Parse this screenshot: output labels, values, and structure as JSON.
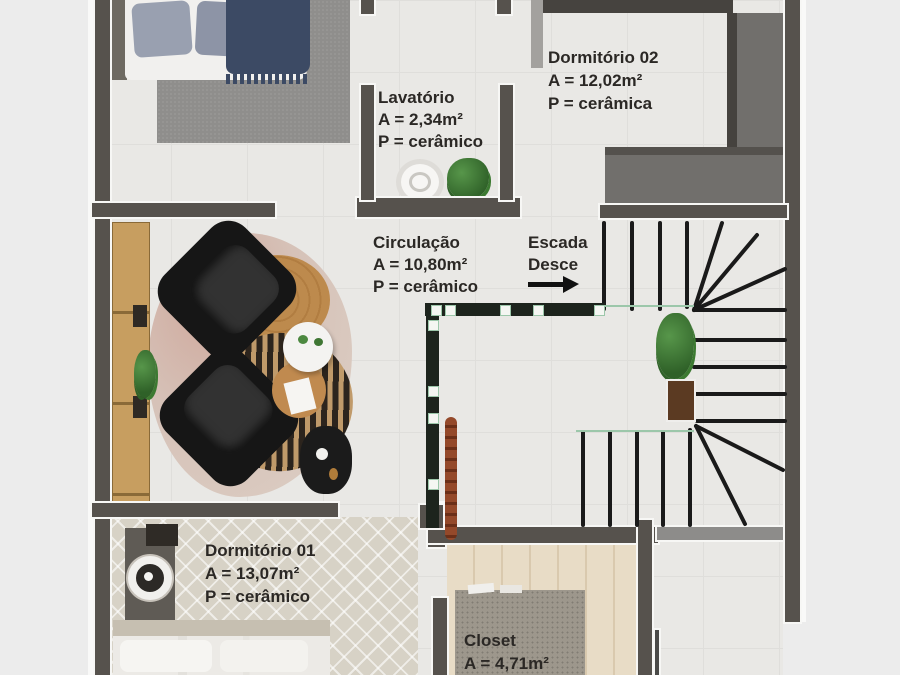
{
  "canvas": {
    "background": "#ececec"
  },
  "palette": {
    "wall": "#56524d",
    "wall_light": "#8d8c8a",
    "floor_tile": "#e9e8e5",
    "closet_wood": "#e8dcc6",
    "rug_gray": "#8f8e8c",
    "rug_diamond": "#d7d2c6",
    "sideboard_wood": "#c59c5e",
    "railing": "#1d241d",
    "glass": "#9cc7aa",
    "stair_line": "#1a1a1a",
    "label_text": "#2b2825"
  },
  "rooms": [
    {
      "name": "Dormitório 02",
      "area": "A = 12,02m²",
      "floor": "P = cerâmica"
    },
    {
      "name": "Lavatório",
      "area": "A = 2,34m²",
      "floor": "P = cerâmico"
    },
    {
      "name": "Circulação",
      "area": "A = 10,80m²",
      "floor": "P = cerâmico"
    },
    {
      "name": "Dormitório 01",
      "area": "A = 13,07m²",
      "floor": "P = cerâmico"
    },
    {
      "name": "Closet",
      "area": "A = 4,71m²",
      "floor": ""
    }
  ],
  "stairs": {
    "label_line1": "Escada",
    "label_line2": "Desce",
    "arrow_icon": "right-arrow"
  }
}
